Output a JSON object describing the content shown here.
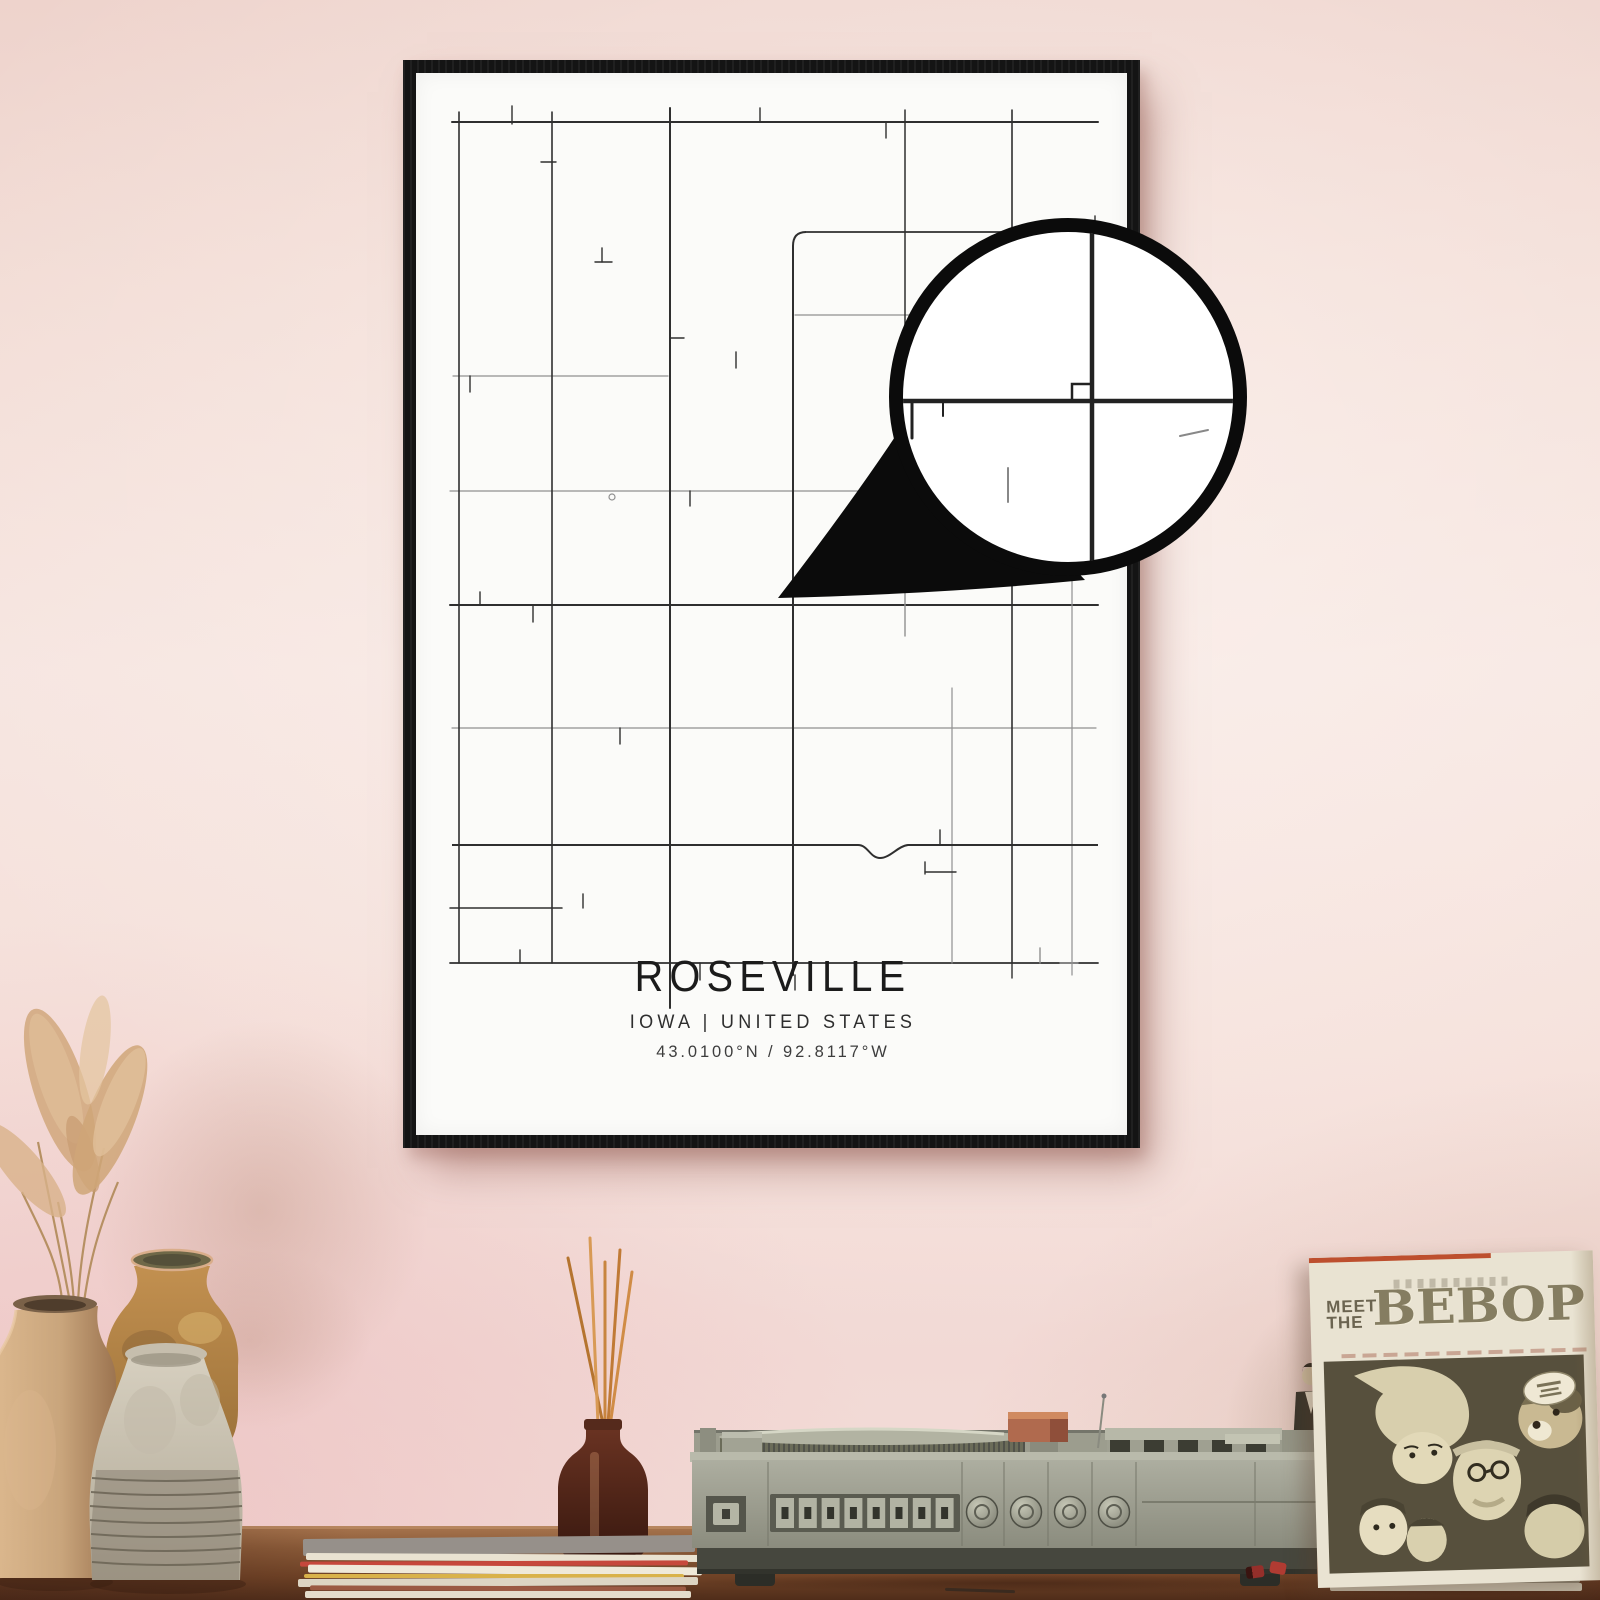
{
  "poster": {
    "title": "ROSEVILLE",
    "subtitle": "IOWA | UNITED STATES",
    "coordinates": "43.0100°N / 92.8117°W"
  },
  "record_sleeve": {
    "meet": "MEET",
    "the": "THE",
    "title": "BEBOP"
  },
  "record_player": {
    "push_buttons": 8,
    "knobs": 4
  },
  "colors": {
    "wall_top": "#eed3cc",
    "wall_mid": "#f6e5e0",
    "wall_low": "#f2d9d5",
    "frame": "#141414",
    "paper": "#fbfbf9",
    "road_dark": "#2f2f2f",
    "road_light": "#909090",
    "magnifier_ink": "#0b0b0b",
    "table_light": "#a8754e",
    "table_dark": "#502d1a",
    "bottle": "#58291a",
    "reeds": "#c8853f",
    "player_body": "#9c9d8e",
    "player_dark": "#46473e",
    "sleeve_paper": "#e9e3d2",
    "sleeve_ink": "#6b6450",
    "sleeve_art_bg": "#57503d",
    "vase_beige": "#c9a57c",
    "vase_ochre": "#b98a47",
    "vase_grey": "#cfc8b8",
    "pampas": "#d1a87e"
  },
  "map": {
    "h_roads": [
      {
        "y": 122,
        "x1": 452,
        "x2": 1098,
        "w": 2,
        "c": "d"
      },
      {
        "y": 232,
        "x1": 806,
        "x2": 1098,
        "w": 1.8,
        "c": "d"
      },
      {
        "y": 315,
        "x1": 795,
        "x2": 1098,
        "w": 1.2,
        "c": "l"
      },
      {
        "y": 376,
        "x1": 453,
        "x2": 668,
        "w": 1.2,
        "c": "l"
      },
      {
        "y": 491,
        "x1": 450,
        "x2": 1098,
        "w": 1.2,
        "c": "l"
      },
      {
        "y": 605,
        "x1": 450,
        "x2": 1098,
        "w": 2,
        "c": "d"
      },
      {
        "y": 728,
        "x1": 452,
        "x2": 1096,
        "w": 1.2,
        "c": "l"
      },
      {
        "y": 908,
        "x1": 450,
        "x2": 562,
        "w": 1.5,
        "c": "d"
      },
      {
        "y": 963,
        "x1": 450,
        "x2": 1098,
        "w": 1.8,
        "c": "d"
      }
    ],
    "v_roads": [
      {
        "x": 459,
        "y1": 112,
        "y2": 963,
        "w": 1.6,
        "c": "d"
      },
      {
        "x": 552,
        "y1": 112,
        "y2": 963,
        "w": 1.6,
        "c": "d"
      },
      {
        "x": 670,
        "y1": 108,
        "y2": 1008,
        "w": 2,
        "c": "d"
      },
      {
        "x": 793,
        "y1": 246,
        "y2": 975,
        "w": 2,
        "c": "d"
      },
      {
        "x": 905,
        "y1": 110,
        "y2": 588,
        "w": 1.5,
        "c": "d"
      },
      {
        "x": 952,
        "y1": 688,
        "y2": 963,
        "w": 1.2,
        "c": "l"
      },
      {
        "x": 1012,
        "y1": 110,
        "y2": 963,
        "w": 1.6,
        "c": "d"
      },
      {
        "x": 1072,
        "y1": 228,
        "y2": 975,
        "w": 1.2,
        "c": "l"
      }
    ],
    "paths": [
      {
        "d": "M806,232 Q793,232 793,246",
        "w": 2,
        "c": "d"
      },
      {
        "d": "M452,845 L858,845 C868,845 870,858 880,858 C890,858 898,846 908,845 L1098,845",
        "w": 2,
        "c": "d"
      }
    ],
    "stubs": [
      [
        512,
        106,
        512,
        124
      ],
      [
        760,
        108,
        760,
        122
      ],
      [
        886,
        122,
        886,
        138
      ],
      [
        1095,
        216,
        1095,
        232
      ],
      [
        541,
        162,
        556,
        162
      ],
      [
        595,
        262,
        612,
        262
      ],
      [
        602,
        248,
        602,
        262
      ],
      [
        670,
        338,
        684,
        338
      ],
      [
        736,
        352,
        736,
        368
      ],
      [
        1012,
        338,
        1026,
        338
      ],
      [
        470,
        376,
        470,
        392
      ],
      [
        690,
        491,
        690,
        506
      ],
      [
        1072,
        450,
        1086,
        450,
        "l"
      ],
      [
        480,
        592,
        480,
        605
      ],
      [
        533,
        605,
        533,
        622
      ],
      [
        865,
        558,
        878,
        558
      ],
      [
        620,
        728,
        620,
        744
      ],
      [
        905,
        592,
        905,
        636,
        "l"
      ],
      [
        940,
        830,
        940,
        845
      ],
      [
        925,
        862,
        925,
        874
      ],
      [
        925,
        872,
        956,
        872
      ],
      [
        583,
        894,
        583,
        908
      ],
      [
        520,
        950,
        520,
        963
      ],
      [
        700,
        963,
        700,
        980
      ],
      [
        1040,
        948,
        1040,
        963,
        "l"
      ],
      [
        1060,
        963,
        1078,
        963,
        "l"
      ],
      [
        795,
        975,
        795,
        990
      ],
      [
        1012,
        963,
        1012,
        978
      ]
    ],
    "circle_mark": [
      612,
      497,
      3
    ],
    "magnifier": {
      "cx": 1068,
      "cy": 397,
      "r": 172,
      "ring": 14,
      "tail": "M778,598 Q860,492 918,402 L1085,580 Q940,594 778,598 Z",
      "cross_x": 1092,
      "cross_y": 401,
      "notch": "M1072,401 L1072,384 L1090,384",
      "inner_stubs": [
        [
          912,
          401,
          912,
          438,
          3,
          "d"
        ],
        [
          943,
          401,
          943,
          416,
          2,
          "d"
        ],
        [
          968,
          214,
          968,
          246,
          2.5,
          "d"
        ],
        [
          1008,
          468,
          1008,
          502,
          2,
          "l"
        ],
        [
          1180,
          436,
          1208,
          430,
          2,
          "l"
        ]
      ]
    }
  },
  "stacks": {
    "left": [
      {
        "x": 303,
        "y": 1537,
        "w": 392,
        "h": 17,
        "c": "#96908a",
        "rot": -0.6
      },
      {
        "x": 306,
        "y": 1554,
        "w": 396,
        "h": 7,
        "c": "#e9e2d1",
        "rot": 0.3
      },
      {
        "x": 300,
        "y": 1561,
        "w": 388,
        "h": 5,
        "c": "#c6483c",
        "rot": -0.2
      },
      {
        "x": 308,
        "y": 1566,
        "w": 394,
        "h": 8,
        "c": "#efe9d9",
        "rot": 0.4
      },
      {
        "x": 304,
        "y": 1574,
        "w": 380,
        "h": 4,
        "c": "#d9b24a",
        "rot": 0
      },
      {
        "x": 298,
        "y": 1578,
        "w": 400,
        "h": 8,
        "c": "#ddd5c3",
        "rot": -0.3
      },
      {
        "x": 310,
        "y": 1586,
        "w": 376,
        "h": 5,
        "c": "#9b5a43",
        "rot": 0.2
      },
      {
        "x": 305,
        "y": 1591,
        "w": 386,
        "h": 7,
        "c": "#e4dccb",
        "rot": 0
      }
    ],
    "right": [
      {
        "x": 1332,
        "y": 1556,
        "w": 252,
        "h": 8,
        "c": "#d9d3c2",
        "rot": 0.5
      },
      {
        "x": 1336,
        "y": 1564,
        "w": 246,
        "h": 6,
        "c": "#53887f",
        "rot": 0.3
      },
      {
        "x": 1330,
        "y": 1570,
        "w": 254,
        "h": 8,
        "c": "#cfc8b6",
        "rot": 0.2
      },
      {
        "x": 1336,
        "y": 1578,
        "w": 244,
        "h": 5,
        "c": "#8b8574",
        "rot": 0
      },
      {
        "x": 1330,
        "y": 1583,
        "w": 252,
        "h": 8,
        "c": "#c2bba9",
        "rot": 0
      }
    ]
  }
}
